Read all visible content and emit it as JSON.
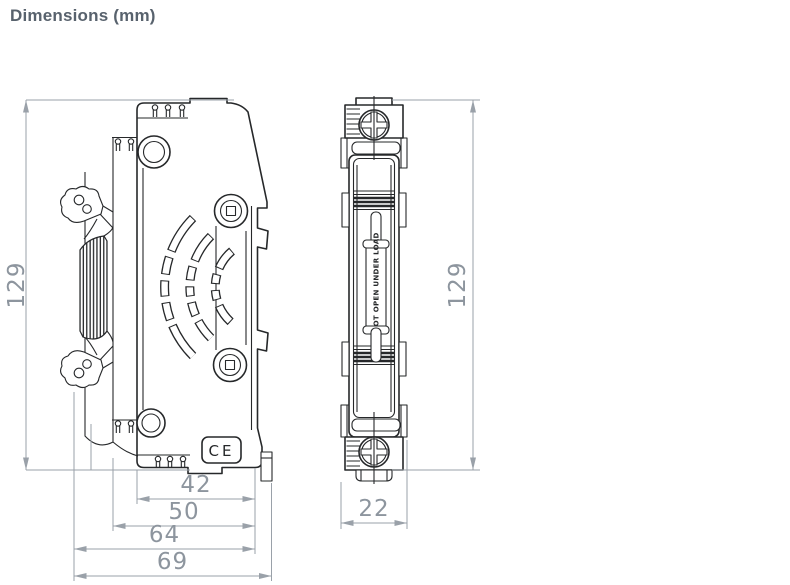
{
  "title": "Dimensions (mm)",
  "side_view": {
    "label": "side-view",
    "height": "129",
    "widths": [
      "42",
      "50",
      "64",
      "69"
    ],
    "ce_mark": "CE"
  },
  "front_view": {
    "label": "front-view",
    "height": "129",
    "width": "22",
    "fuse_label": "DO NOT OPEN UNDER LOAD"
  },
  "colors": {
    "line": "#26282a",
    "dimension": "#9aa1a9",
    "dimension_text": "#8d959e",
    "title": "#58626d",
    "background": "#ffffff"
  }
}
